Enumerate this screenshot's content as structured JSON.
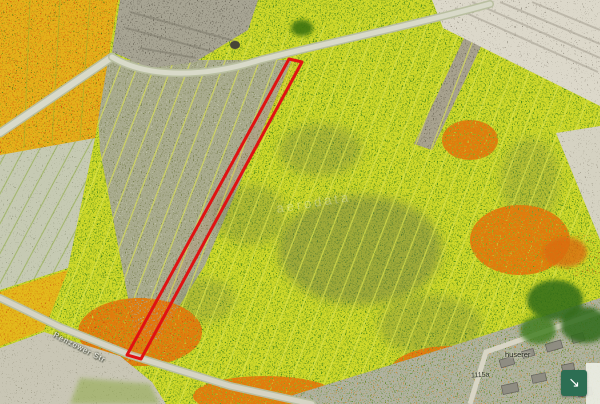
{
  "map": {
    "type": "aerial-ndvi-vegetation-index-view",
    "labels": {
      "road_name": "Renzower Str",
      "village_name": "huserer",
      "parcel_number": "1115a",
      "watermark": "aerodata"
    },
    "selection": {
      "name": "selected-parcel",
      "shape": "long narrow strip outlined in red",
      "outline_color": "#e01212"
    },
    "ndvi_palette": {
      "high_vigor_green": "#4c8a1a",
      "medium_yellow": "#cfd92b",
      "low_orange": "#e07c10",
      "stress_red": "#c43a0a",
      "bare_soil_gray": "#b3ad9c"
    },
    "controls": {
      "expand_button": {
        "glyph": "↘",
        "icon": "arrow-down-right",
        "background": "#2c6e53"
      }
    }
  }
}
